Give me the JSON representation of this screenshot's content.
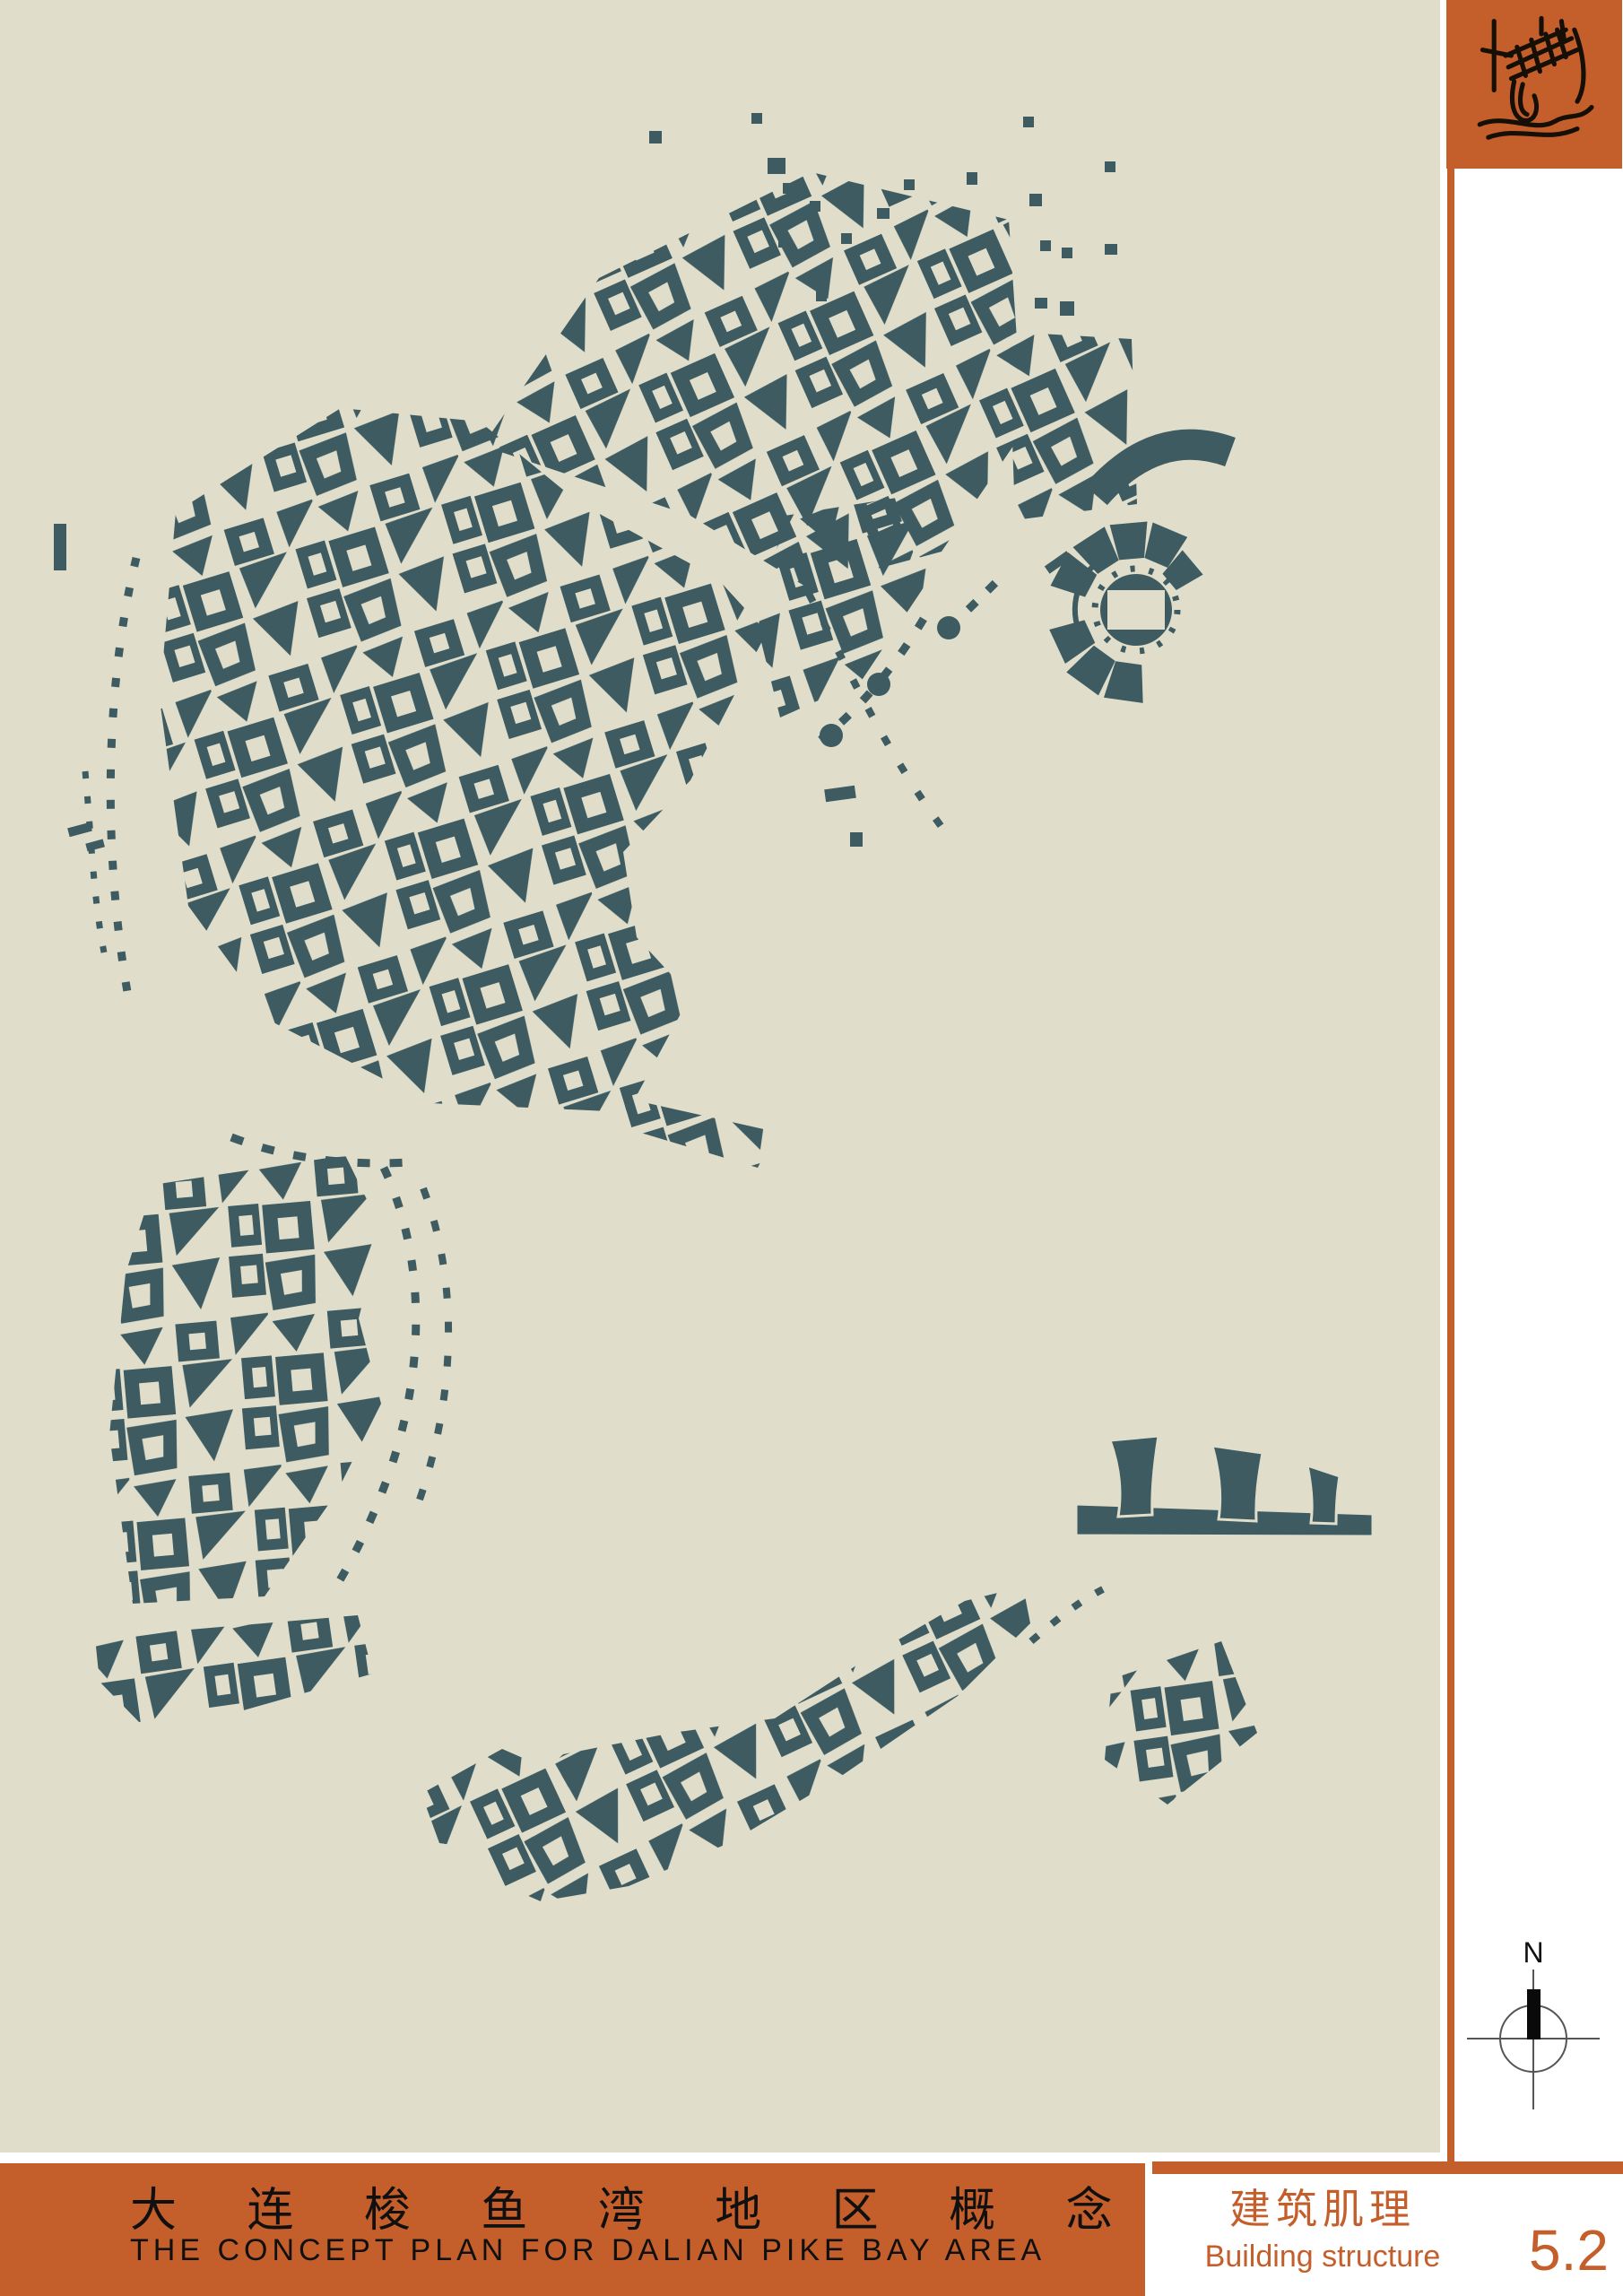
{
  "poster": {
    "main_title_zh": "大 连 梭 鱼 湾 地 区 概 念 规 划",
    "main_title_en": "THE CONCEPT PLAN FOR DALIAN PIKE BAY AREA",
    "sheet": {
      "title_zh": "建筑肌理",
      "title_en": "Building structure",
      "number": "5.2"
    },
    "compass": {
      "label": "N"
    }
  },
  "colors": {
    "paper": "#ffffff",
    "map_background": "#e0decb",
    "building": "#3d5b61",
    "accent_orange": "#c45f2c",
    "title_text": "#101010"
  },
  "icons": [
    "site-sketch-logo-icon",
    "north-compass-icon"
  ],
  "map_features": [
    "building-fabric-cluster-north",
    "building-fabric-cluster-west",
    "building-fabric-cluster-southwest",
    "building-fabric-ribbon-south",
    "stadium-figure",
    "sail-shaped-buildings",
    "curved-arc-building",
    "dashed-path-lines",
    "scattered-buildings"
  ]
}
